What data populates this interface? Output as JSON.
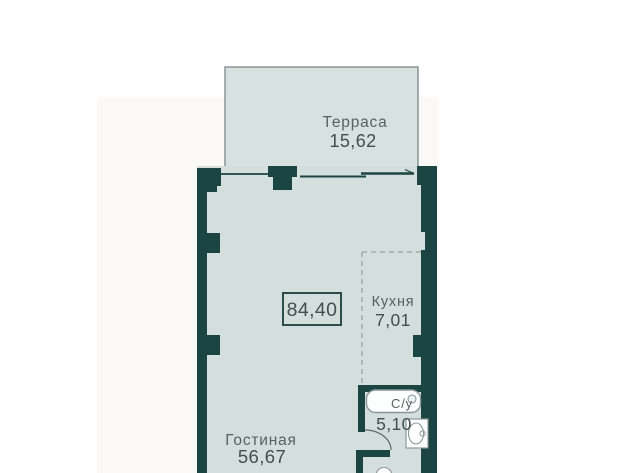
{
  "rooms": {
    "terrace": {
      "name": "Терраса",
      "area": "15,62"
    },
    "kitchen": {
      "name": "Кухня",
      "area": "7,01"
    },
    "bathroom": {
      "name": "С/у",
      "area": "5,10"
    },
    "living_room": {
      "name": "Гостиная",
      "area": "56,67"
    }
  },
  "total_area": "84,40",
  "colors": {
    "wall": "#1a4543",
    "floor": "#d3dedd",
    "terrace_floor": "#d7e1e0",
    "outline": "#82908f",
    "fixture_stroke": "#8a9898",
    "dashed_zone": "#97a3a2",
    "room_label": "#57615f",
    "area_label": "#434e4d",
    "background": "#ffffff",
    "background_band": "#fbf8f8"
  }
}
